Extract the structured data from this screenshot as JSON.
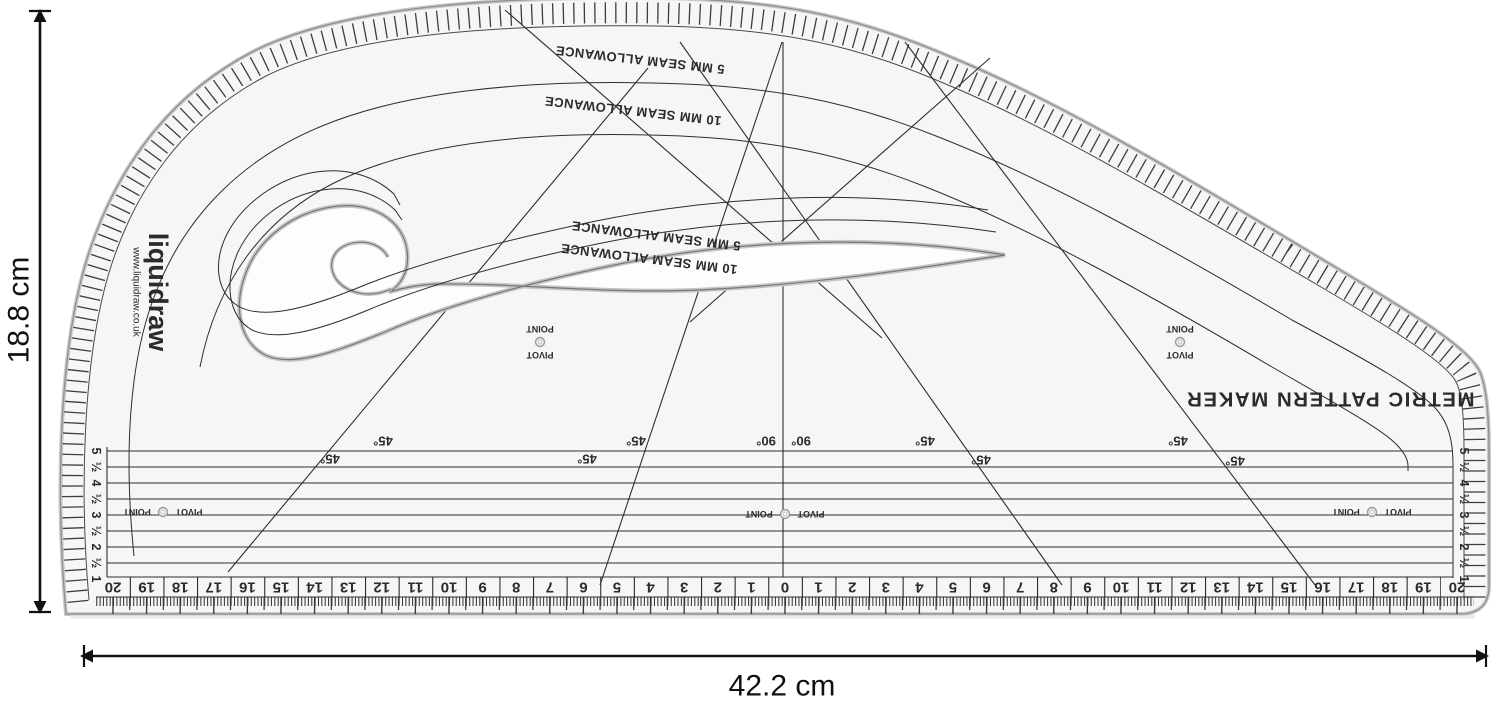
{
  "product": {
    "brand": "liquidraw",
    "website": "www.liquidraw.co.uk",
    "name": "METRIC PATTERN MAKER"
  },
  "dimensions": {
    "height": "18.8 cm",
    "width": "42.2 cm"
  },
  "labels": {
    "seam_outer_5": "5 MM SEAM ALLOWANCE",
    "seam_outer_10": "10 MM SEAM ALLOWANCE",
    "seam_inner_5": "5 MM SEAM ALLOWANCE",
    "seam_inner_10": "10 MM SEAM ALLOWANCE",
    "pivot": "PIVOT",
    "point": "POINT",
    "deg45": "45°",
    "deg90": "90°"
  },
  "scales": {
    "bottom": [
      20,
      19,
      18,
      17,
      16,
      15,
      14,
      13,
      12,
      11,
      10,
      9,
      8,
      7,
      6,
      5,
      4,
      3,
      2,
      1,
      0,
      1,
      2,
      3,
      4,
      5,
      6,
      7,
      8,
      9,
      10,
      11,
      12,
      13,
      14,
      15,
      16,
      17,
      18,
      19,
      20
    ],
    "side": [
      "1",
      "½",
      "2",
      "½",
      "3",
      "½",
      "4",
      "½",
      "5"
    ]
  },
  "colors": {
    "body": "#f6f6f6",
    "line": "#2e2e2e",
    "edge": "#9a9a9a",
    "annotation": "#111111"
  }
}
